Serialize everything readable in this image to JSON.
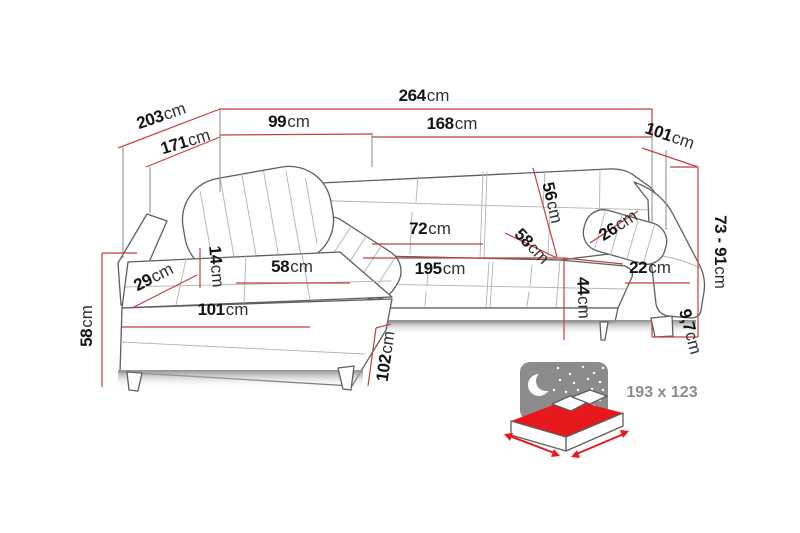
{
  "diagram": {
    "subject": "corner-sofa-dimension-diagram",
    "colors": {
      "dimension_line": "#c43f3f",
      "sofa_outline": "#5e5e5e",
      "tuft_line": "#b2b2b2",
      "icon_gray": "#8c8c8c",
      "bed_red": "#e8191c",
      "label_text": "#141414"
    }
  },
  "dimensions": {
    "total_width": {
      "num": "264",
      "unit": "cm"
    },
    "total_depth": {
      "num": "203",
      "unit": "cm"
    },
    "inner_depth": {
      "num": "171",
      "unit": "cm"
    },
    "left_section_width": {
      "num": "99",
      "unit": "cm"
    },
    "right_section_width": {
      "num": "168",
      "unit": "cm"
    },
    "right_side_depth": {
      "num": "101",
      "unit": "cm"
    },
    "back_height_range": {
      "num": "73 - 91",
      "unit": "cm"
    },
    "backrest_height": {
      "num": "56",
      "unit": "cm"
    },
    "seat_depth": {
      "num": "58",
      "unit": "cm"
    },
    "headrest_width": {
      "num": "26",
      "unit": "cm"
    },
    "back_cushion_width": {
      "num": "72",
      "unit": "cm"
    },
    "chaise_seat_width": {
      "num": "58",
      "unit": "cm"
    },
    "seat_front_width": {
      "num": "195",
      "unit": "cm"
    },
    "armrest_width": {
      "num": "22",
      "unit": "cm"
    },
    "seat_height": {
      "num": "44",
      "unit": "cm"
    },
    "cushion_thickness": {
      "num": "14",
      "unit": "cm"
    },
    "chaise_arm_width": {
      "num": "29",
      "unit": "cm"
    },
    "chaise_front_width": {
      "num": "101",
      "unit": "cm"
    },
    "side_height": {
      "num": "58",
      "unit": "cm"
    },
    "chaise_length": {
      "num": "102",
      "unit": "cm"
    },
    "leg_height": {
      "num": "9,7",
      "unit": "cm"
    }
  },
  "bed_function": {
    "sleeping_area": "193 x 123",
    "icon": "sofa-bed-night-icon"
  }
}
